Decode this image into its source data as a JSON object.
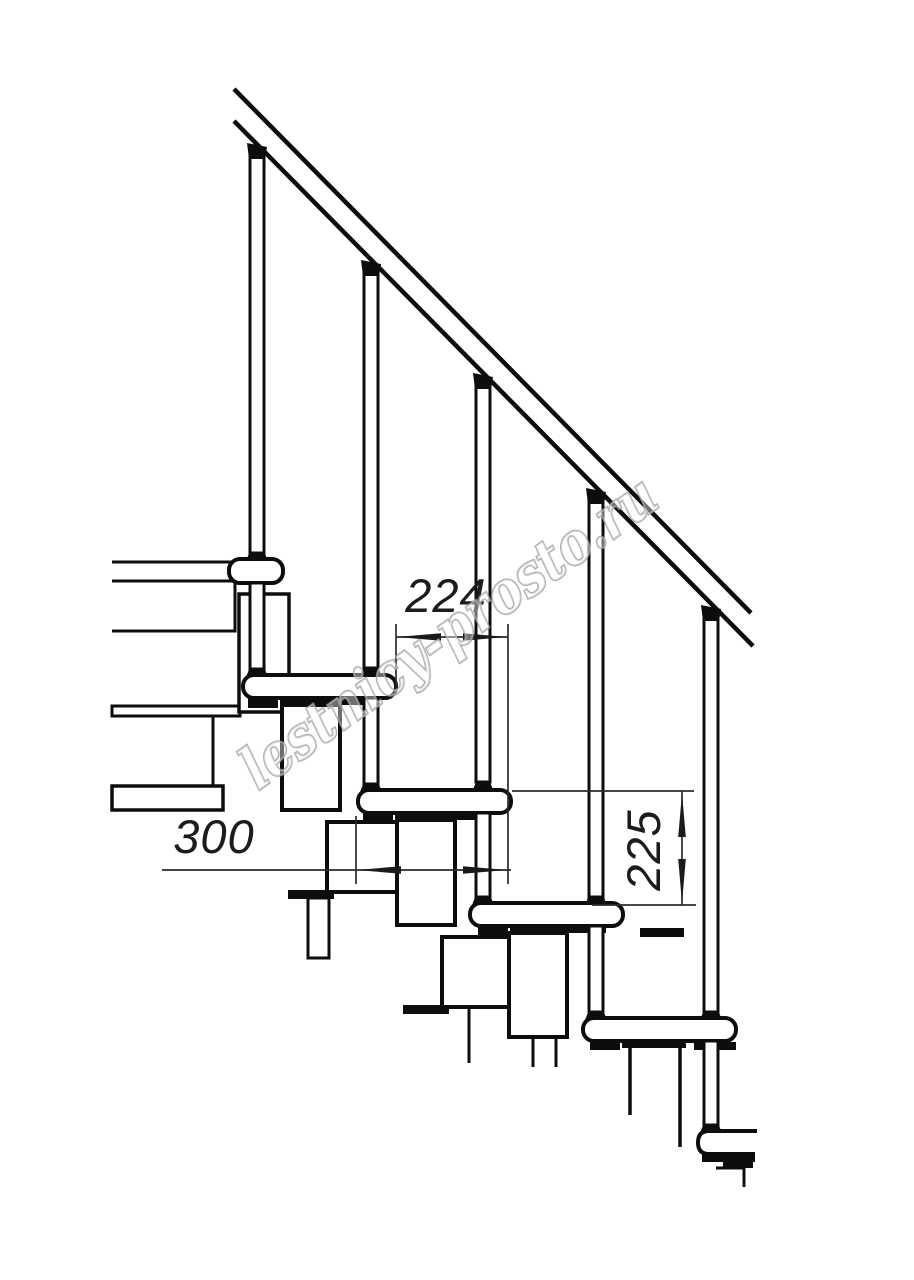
{
  "title": "Modular staircase side elevation technical drawing",
  "dims": {
    "tread_pitch": "224",
    "tread_depth": "300",
    "riser_height": "225"
  },
  "watermark": {
    "text": "lestnicy-prosto.ru",
    "color": "#989898"
  },
  "colors": {
    "background": "#ffffff",
    "line": "#0d0d0d",
    "dimension_line": "#2b2b2b"
  }
}
